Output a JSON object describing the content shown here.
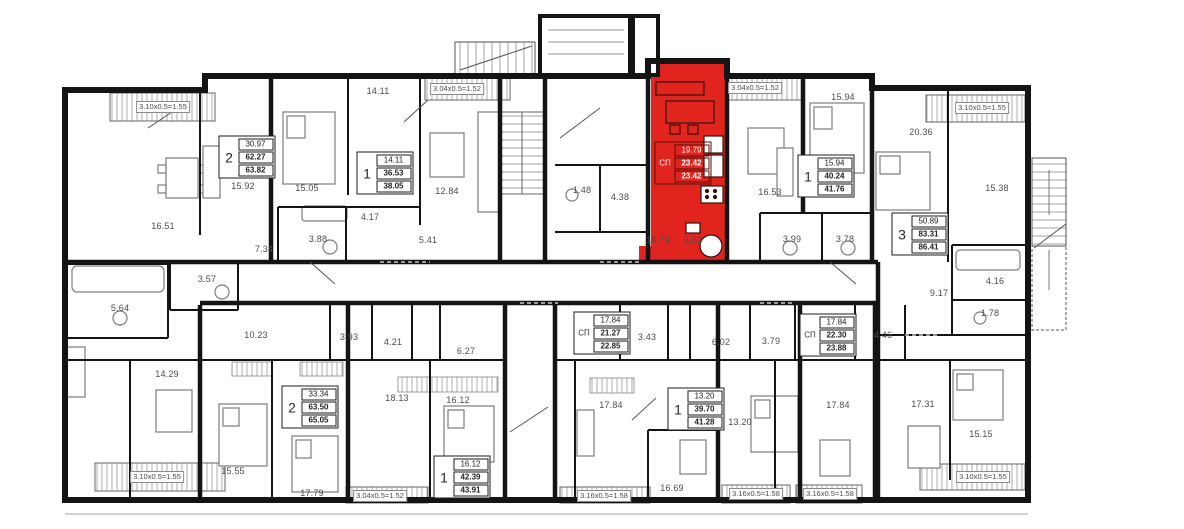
{
  "plan_title": "floor-plan",
  "colors": {
    "wall": "#141414",
    "highlight": "#e2241f",
    "label": "#4c4c4c",
    "furniture": "#7d7d7d",
    "background": "#ffffff"
  },
  "highlighted_unit": {
    "type_label": "СП",
    "living_area": "19.79",
    "area": "23.42",
    "total_area": "23.42",
    "room_areas": [
      "19.79",
      "3.63"
    ]
  },
  "room_labels": [
    {
      "t": "16.51",
      "x": 163,
      "y": 226
    },
    {
      "t": "15.92",
      "x": 243,
      "y": 186
    },
    {
      "t": "15.05",
      "x": 307,
      "y": 188
    },
    {
      "t": "14.11",
      "x": 378,
      "y": 91
    },
    {
      "t": "12.84",
      "x": 447,
      "y": 191
    },
    {
      "t": "5.41",
      "x": 428,
      "y": 240
    },
    {
      "t": "7.34",
      "x": 264,
      "y": 249
    },
    {
      "t": "3.88",
      "x": 318,
      "y": 239
    },
    {
      "t": "4.17",
      "x": 370,
      "y": 217
    },
    {
      "t": "3.57",
      "x": 207,
      "y": 279
    },
    {
      "t": "1.48",
      "x": 582,
      "y": 190
    },
    {
      "t": "4.38",
      "x": 620,
      "y": 197
    },
    {
      "t": "19.79",
      "x": 658,
      "y": 240
    },
    {
      "t": "3.63",
      "x": 693,
      "y": 240
    },
    {
      "t": "16.53",
      "x": 770,
      "y": 192
    },
    {
      "t": "15.94",
      "x": 843,
      "y": 97
    },
    {
      "t": "3.99",
      "x": 792,
      "y": 239
    },
    {
      "t": "3.78",
      "x": 845,
      "y": 239
    },
    {
      "t": "20.36",
      "x": 921,
      "y": 132
    },
    {
      "t": "15.38",
      "x": 997,
      "y": 188
    },
    {
      "t": "4.16",
      "x": 995,
      "y": 281
    },
    {
      "t": "1.78",
      "x": 990,
      "y": 313
    },
    {
      "t": "9.17",
      "x": 939,
      "y": 293
    },
    {
      "t": "4.46",
      "x": 883,
      "y": 335
    },
    {
      "t": "5.64",
      "x": 120,
      "y": 308
    },
    {
      "t": "10.23",
      "x": 256,
      "y": 335
    },
    {
      "t": "3.93",
      "x": 349,
      "y": 337
    },
    {
      "t": "4.21",
      "x": 393,
      "y": 342
    },
    {
      "t": "6.27",
      "x": 466,
      "y": 351
    },
    {
      "t": "3.43",
      "x": 647,
      "y": 337
    },
    {
      "t": "6.02",
      "x": 721,
      "y": 342
    },
    {
      "t": "3.79",
      "x": 771,
      "y": 341
    },
    {
      "t": "14.29",
      "x": 167,
      "y": 374
    },
    {
      "t": "15.55",
      "x": 233,
      "y": 471
    },
    {
      "t": "17.79",
      "x": 312,
      "y": 493
    },
    {
      "t": "18.13",
      "x": 397,
      "y": 398
    },
    {
      "t": "16.12",
      "x": 458,
      "y": 400
    },
    {
      "t": "17.84",
      "x": 611,
      "y": 405
    },
    {
      "t": "16.69",
      "x": 672,
      "y": 488
    },
    {
      "t": "13.20",
      "x": 740,
      "y": 422
    },
    {
      "t": "17.84",
      "x": 838,
      "y": 405
    },
    {
      "t": "17.31",
      "x": 923,
      "y": 404
    },
    {
      "t": "15.15",
      "x": 981,
      "y": 434
    }
  ],
  "dimension_labels": [
    {
      "t": "3.10x0.5=1.55",
      "x": 163,
      "y": 107
    },
    {
      "t": "3.04x0.5=1.52",
      "x": 457,
      "y": 89
    },
    {
      "t": "3.04x0.5=1.52",
      "x": 755,
      "y": 88
    },
    {
      "t": "3.10x0.5=1.55",
      "x": 982,
      "y": 108
    },
    {
      "t": "3.10x0.5=1.55",
      "x": 157,
      "y": 477
    },
    {
      "t": "3.04x0.5=1.52",
      "x": 380,
      "y": 496
    },
    {
      "t": "3.16x0.5=1.58",
      "x": 604,
      "y": 496
    },
    {
      "t": "3.16x0.5=1.58",
      "x": 756,
      "y": 494
    },
    {
      "t": "3.16x0.5=1.58",
      "x": 830,
      "y": 494
    },
    {
      "t": "3.10x0.5=1.55",
      "x": 983,
      "y": 477
    }
  ],
  "stamps": [
    {
      "rooms": "2",
      "values": [
        "30.97",
        "62.27",
        "63.82"
      ],
      "x": 247,
      "y": 157,
      "highlighted": false
    },
    {
      "rooms": "1",
      "values": [
        "14.11",
        "36.53",
        "38.05"
      ],
      "x": 385,
      "y": 173,
      "highlighted": false
    },
    {
      "rooms": "СП",
      "values": [
        "19.79",
        "23.42",
        "23.42"
      ],
      "x": 683,
      "y": 163,
      "highlighted": true
    },
    {
      "rooms": "1",
      "values": [
        "15.94",
        "40.24",
        "41.76"
      ],
      "x": 826,
      "y": 176,
      "highlighted": false
    },
    {
      "rooms": "3",
      "values": [
        "50.89",
        "83.31",
        "86.41"
      ],
      "x": 920,
      "y": 234,
      "highlighted": false
    },
    {
      "rooms": "СП",
      "values": [
        "17.84",
        "21.27",
        "22.85"
      ],
      "x": 602,
      "y": 333,
      "highlighted": false
    },
    {
      "rooms": "СП",
      "values": [
        "17.84",
        "22.30",
        "23.88"
      ],
      "x": 828,
      "y": 335,
      "highlighted": false
    },
    {
      "rooms": "2",
      "values": [
        "33.34",
        "63.50",
        "65.05"
      ],
      "x": 310,
      "y": 407,
      "highlighted": false
    },
    {
      "rooms": "1",
      "values": [
        "16.12",
        "42.39",
        "43.91"
      ],
      "x": 462,
      "y": 477,
      "highlighted": false
    },
    {
      "rooms": "1",
      "values": [
        "13.20",
        "39.70",
        "41.28"
      ],
      "x": 696,
      "y": 409,
      "highlighted": false
    }
  ]
}
